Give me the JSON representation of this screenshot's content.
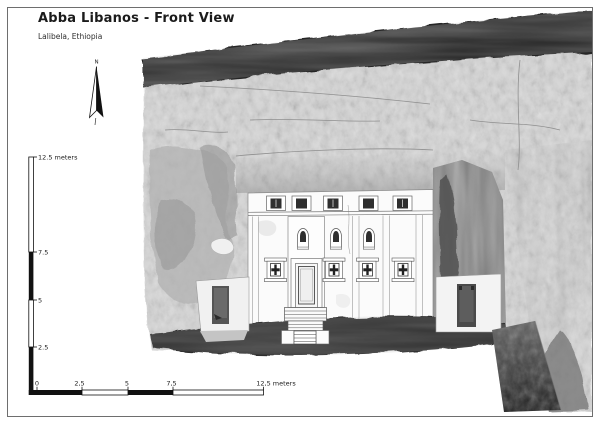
{
  "header": {
    "title": "Abba Libanos - Front View",
    "subtitle": "Lalibela, Ethiopia"
  },
  "compass": {
    "label": "N",
    "icon": "north-arrow-icon"
  },
  "scale_bars": {
    "vertical": {
      "labels": [
        "12.5 meters",
        "7.5",
        "5",
        "2.5"
      ]
    },
    "horizontal": {
      "labels": [
        "0",
        "2,5",
        "5",
        "7,5",
        "12,5 meters"
      ]
    }
  },
  "illustration": {
    "subject": "laser-scan elevation of rock-hewn church facade in cliff niche",
    "colors": {
      "rock_light": "#d7d7d7",
      "rock_overhang_dark": "#262626",
      "niche_shadow": "#787878",
      "ground_shadow": "#2f2f2f",
      "facade": "#fbfbfb",
      "frame_border": "#6e6e6e"
    }
  }
}
